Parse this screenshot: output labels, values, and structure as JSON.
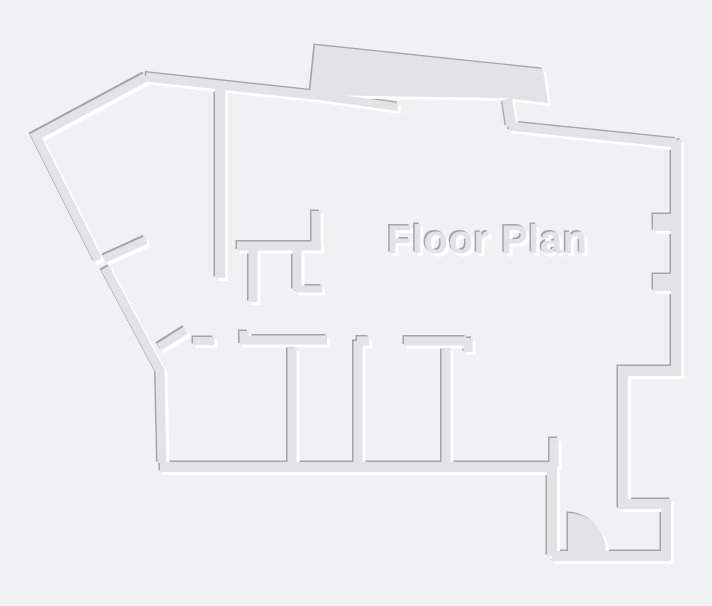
{
  "title": "Floor Plan",
  "colors": {
    "background": "#f0f1f2",
    "wall": "#e1e3e4",
    "edge_dark": "#a4a5a6",
    "edge_light": "#ffffff"
  }
}
